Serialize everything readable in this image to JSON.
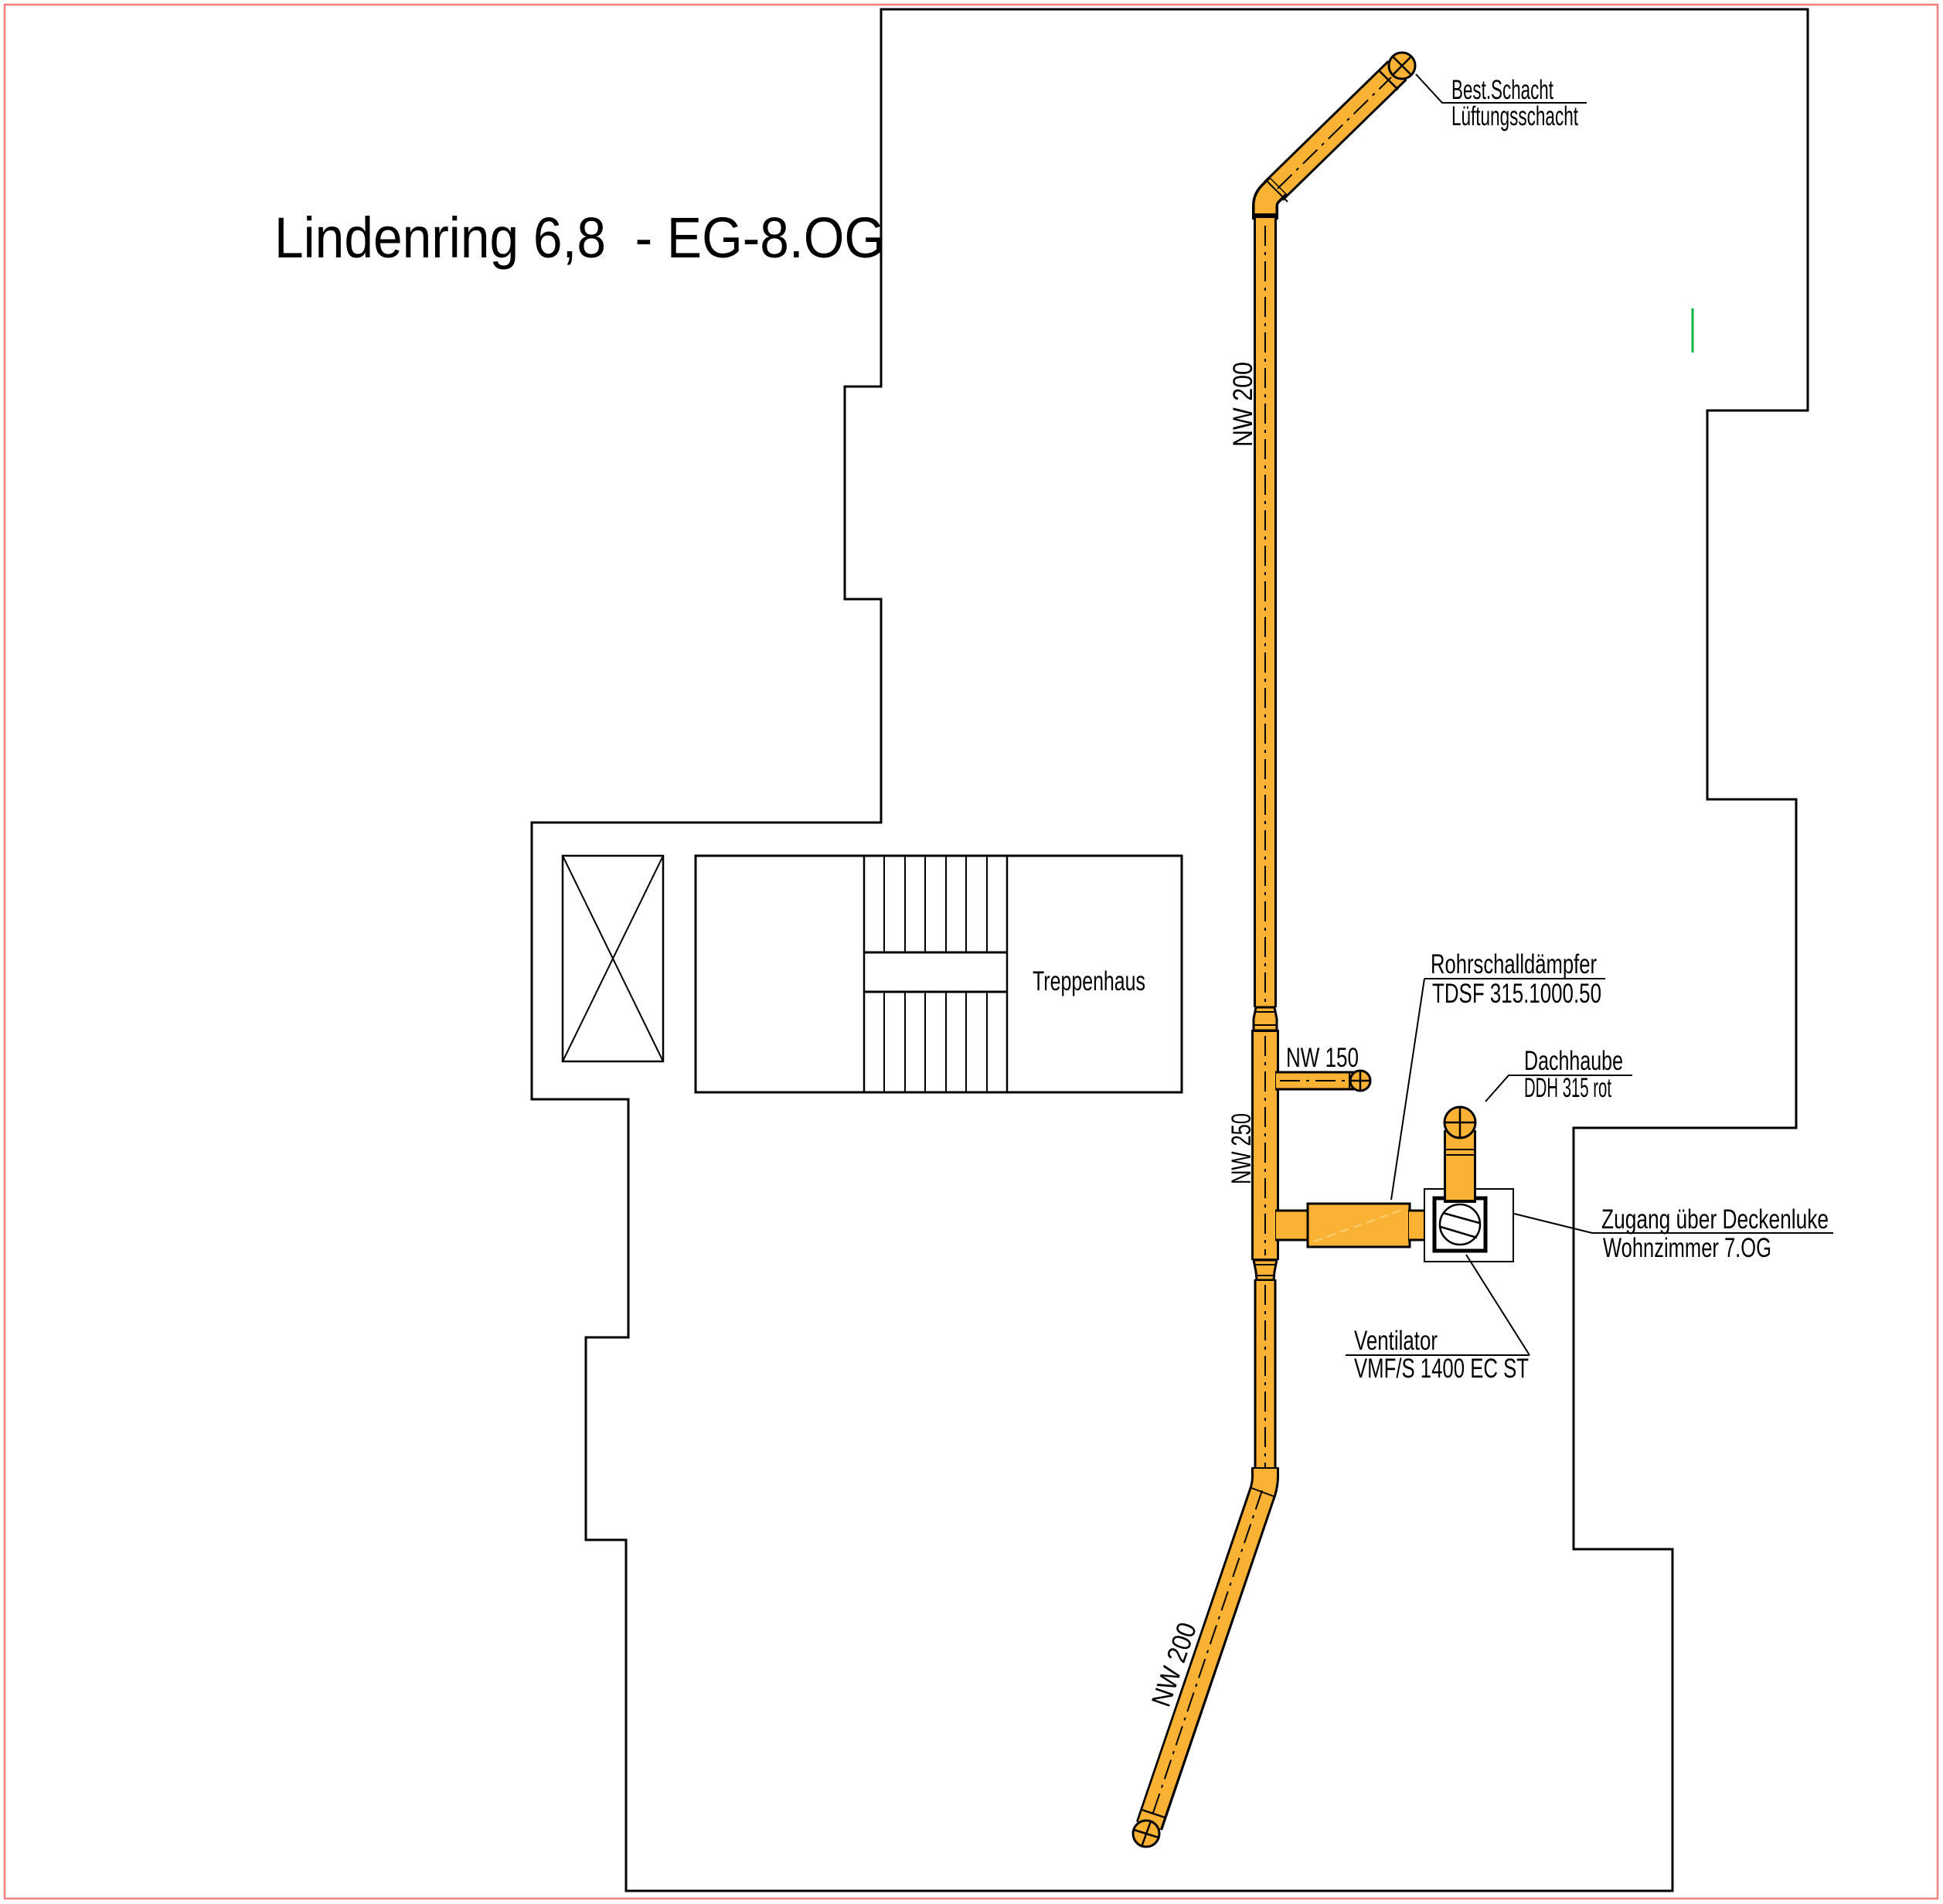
{
  "title": "Lindenring 6,8  - EG-8.OG",
  "room_labels": {
    "treppenhaus": "Treppenhaus"
  },
  "duct_size_labels": {
    "nw200_upper": "NW 200",
    "nw150_branch": "NW 150",
    "nw250_riser": "NW 250",
    "nw200_lower": "NW 200"
  },
  "annotations": {
    "best_schacht": {
      "line1": "Best.Schacht",
      "line2": "Lüftungsschacht"
    },
    "rohrschalldaempfer": {
      "line1": "Rohrschalldämpfer",
      "line2": "TDSF 315.1000.50"
    },
    "dachhaube": {
      "line1": "Dachhaube",
      "line2": "DDH 315 rot"
    },
    "zugang": {
      "line1": "Zugang über Deckenluke",
      "line2": "Wohnzimmer 7.OG"
    },
    "ventilator": {
      "line1": "Ventilator",
      "line2": "VMF/S 1400 EC ST"
    }
  },
  "colors": {
    "duct_fill": "#F9B233",
    "duct_light": "#FBCF77",
    "ink": "#000000",
    "page_border": "#F08080",
    "marker_green": "#00B33C"
  }
}
